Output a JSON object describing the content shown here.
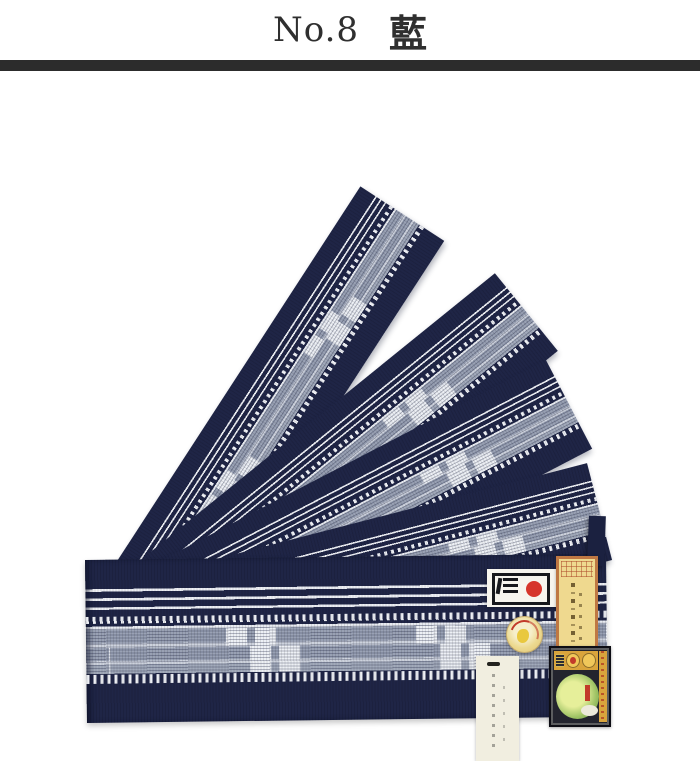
{
  "header": {
    "product_number": "No.8",
    "color_name": "藍",
    "text_color": "#2f2f2f",
    "divider_color": "#2c2c2c"
  },
  "photo": {
    "subject": "Five indigo-navy woven obi belts fanned out on a white background",
    "belt_count": 5,
    "pattern": "wide navy band, three white pinstripes, dashed white band, gray kasuri band with white blocks, dashed white band, navy band",
    "colors": {
      "navy": "#1f2546",
      "stripe_white": "#edeff4",
      "kasuri_gray": "#99a1b4",
      "kasuri_light": "#cdd2dd"
    },
    "labels": [
      {
        "name": "brand-logo-label",
        "description": "white card, black framed mark with bars and red sun circle",
        "colors": [
          "#f7f5ee",
          "#17181c",
          "#d6352b"
        ]
      },
      {
        "name": "orange-paper-label",
        "description": "vertical gold paper label with orange border and calligraphy",
        "colors": [
          "#bf7843",
          "#efd98f"
        ]
      },
      {
        "name": "gold-seal-sticker",
        "description": "round gold paper seal with red crest marks",
        "colors": [
          "#ecd98f",
          "#c23b2a",
          "#e9c83e"
        ]
      },
      {
        "name": "paper-hang-tag",
        "description": "cream hang tag with slit and faint vertical text",
        "colors": [
          "#f1eee0"
        ]
      },
      {
        "name": "trademark-label",
        "description": "dark label with gold header seals, gold side strip and green globe crest",
        "colors": [
          "#23242e",
          "#d9a43c",
          "#9cc163",
          "#c23b2a"
        ]
      }
    ]
  }
}
